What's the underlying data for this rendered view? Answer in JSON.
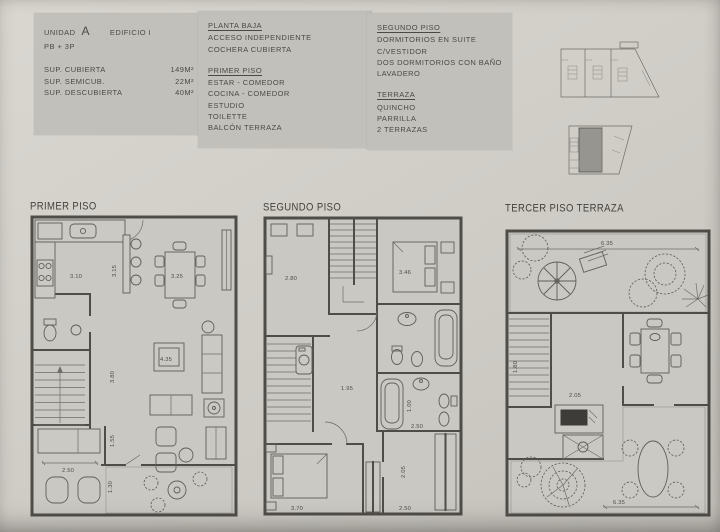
{
  "panels": {
    "unit": {
      "unit_label": "UNIDAD",
      "unit_value": "A",
      "building": "EDIFICIO I",
      "floors": "PB + 3P",
      "areas": [
        {
          "label": "SUP. CUBIERTA",
          "value": "149M²"
        },
        {
          "label": "SUP. SEMICUB.",
          "value": "22M²"
        },
        {
          "label": "SUP. DESCUBIERTA",
          "value": "40M²"
        }
      ]
    },
    "levels_a": {
      "sections": [
        {
          "title": "PLANTA BAJA",
          "items": [
            "ACCESO INDEPENDIENTE",
            "COCHERA CUBIERTA"
          ]
        },
        {
          "title": "PRIMER PISO",
          "items": [
            "ESTAR - COMEDOR",
            "COCINA - COMEDOR",
            "ESTUDIO",
            "TOILETTE",
            "BALCÓN TERRAZA"
          ]
        }
      ]
    },
    "levels_b": {
      "sections": [
        {
          "title": "SEGUNDO PISO",
          "items": [
            "DORMITORIOS EN SUITE",
            "C/VESTIDOR",
            "DOS DORMITORIOS CON BAÑO",
            "LAVADERO"
          ]
        },
        {
          "title": "TERRAZA",
          "items": [
            "QUINCHO",
            "PARRILLA",
            "2 TERRAZAS"
          ]
        }
      ]
    }
  },
  "plans": [
    {
      "label": "PRIMER PISO",
      "dims": {
        "kitchen": "3.10",
        "island": "3.15",
        "dining": "3.25",
        "living": "4.35",
        "living_len": "3.80",
        "hall": "1.55",
        "study": "2.50",
        "balcony": "1.30"
      }
    },
    {
      "label": "SEGUNDO PISO",
      "dims": {
        "bedroom1": "2.80",
        "bedroom2": "3.46",
        "hall": "1.95",
        "bath": "2.50",
        "bath_depth": "1.00",
        "bedroom3": "3.70",
        "vestidor_len": "2.05",
        "vestidor": "2.50"
      }
    },
    {
      "label": "TERCER PISO TERRAZA",
      "dims": {
        "terrace_top": "6.35",
        "quincho_len": "1.80",
        "quincho": "2.05",
        "terrace_bottom": "6.35"
      }
    }
  ]
}
